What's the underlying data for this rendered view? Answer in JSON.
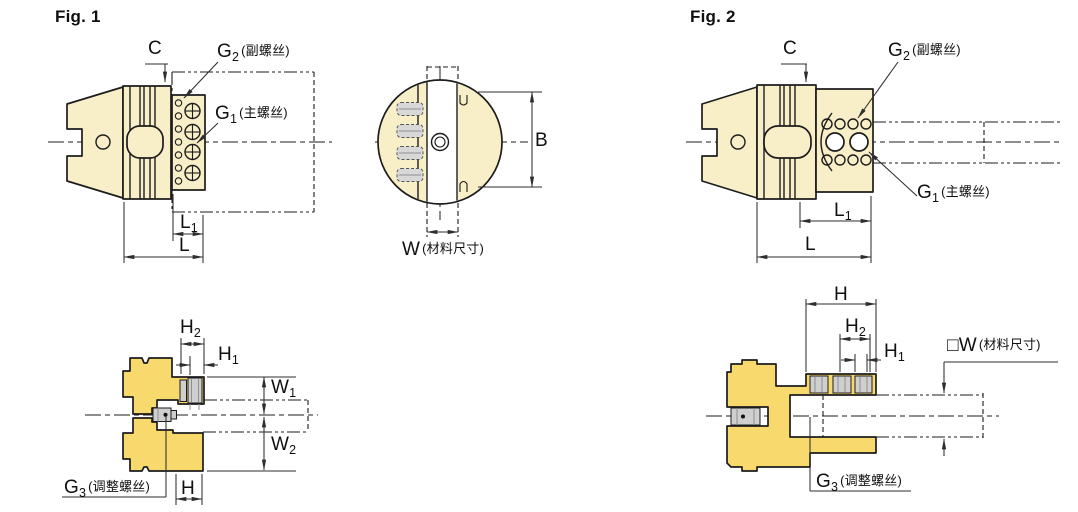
{
  "colors": {
    "line": "#1c1c1c",
    "dim": "#2e2e2e",
    "cream": "#f8eec7",
    "gold": "#f7d96e",
    "gray": "#cfcfcf",
    "gray-dark": "#8f8f8f"
  },
  "fig1": {
    "title": "Fig. 1",
    "c": "C",
    "g2": {
      "base": "G",
      "sub": "2",
      "note": "(副螺丝)"
    },
    "g1": {
      "base": "G",
      "sub": "1",
      "note": "(主螺丝)"
    },
    "l1": {
      "base": "L",
      "sub": "1"
    },
    "l": "L"
  },
  "front_view": {
    "b": "B",
    "w_base": "W",
    "w_note": "(材料尺寸)"
  },
  "fig2": {
    "title": "Fig. 2",
    "c": "C",
    "g2": {
      "base": "G",
      "sub": "2",
      "note": "(副螺丝)"
    },
    "g1": {
      "base": "G",
      "sub": "1",
      "note": "(主螺丝)"
    },
    "l1": {
      "base": "L",
      "sub": "1"
    },
    "l": "L"
  },
  "section1": {
    "h2": {
      "base": "H",
      "sub": "2"
    },
    "h1": {
      "base": "H",
      "sub": "1"
    },
    "w1": {
      "base": "W",
      "sub": "1"
    },
    "w2": {
      "base": "W",
      "sub": "2"
    },
    "h": "H",
    "g3": {
      "base": "G",
      "sub": "3",
      "note": "(调整螺丝)"
    }
  },
  "section2": {
    "h": "H",
    "h2": {
      "base": "H",
      "sub": "2"
    },
    "h1": {
      "base": "H",
      "sub": "1"
    },
    "w_box": "□",
    "w_base": "W",
    "w_note": "(材料尺寸)",
    "g3": {
      "base": "G",
      "sub": "3",
      "note": "(调整螺丝)"
    }
  }
}
